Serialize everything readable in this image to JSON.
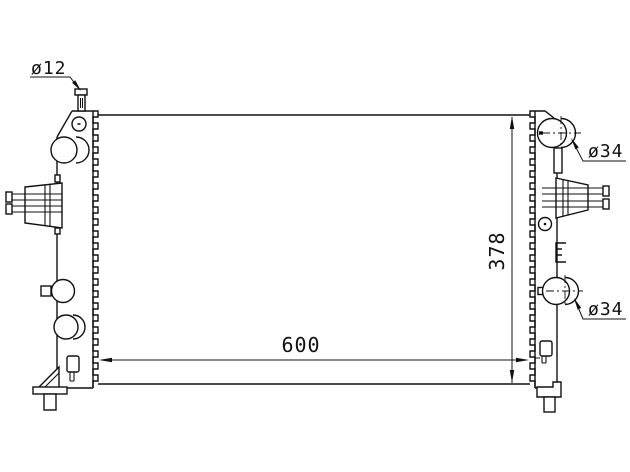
{
  "drawing": {
    "labels": {
      "pin_diameter": "ø12",
      "top_port_diameter": "ø34",
      "bottom_port_diameter": "ø34",
      "core_width": "600",
      "core_height": "378"
    },
    "colors": {
      "line": "#111111",
      "background": "#ffffff"
    }
  }
}
